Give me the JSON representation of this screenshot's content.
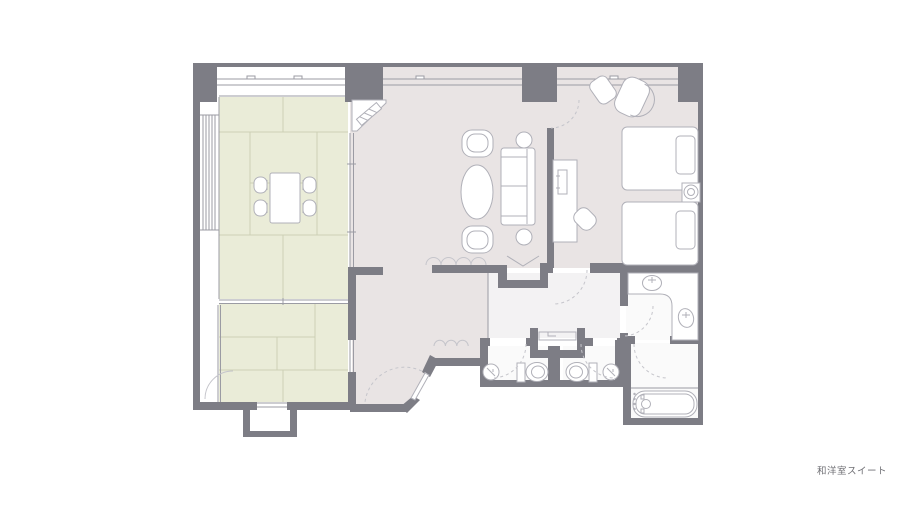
{
  "caption": {
    "text": "和洋室スイート"
  },
  "colors": {
    "background": "#ffffff",
    "wall": "#7d7d85",
    "wall_light": "#9b9ba3",
    "tatami": "#eaecd8",
    "tatami_line": "#cdd0b6",
    "floor_pink": "#e9e4e4",
    "floor_service": "#f3f2f3",
    "floor_white": "#fafafa",
    "furniture_stroke": "#b0b0b8",
    "door_arc": "#c5c5cb",
    "caption_color": "#6f6f74"
  }
}
